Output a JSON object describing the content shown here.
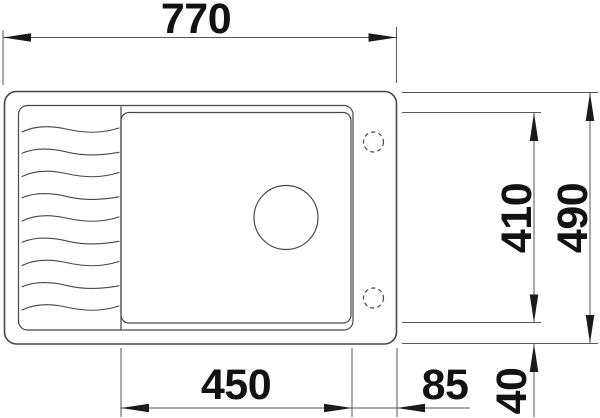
{
  "meta": {
    "drawing_type": "technical dimension drawing",
    "subject": "inset kitchen sink with drainboard, top view"
  },
  "colors": {
    "background": "#ffffff",
    "outline": "#474747",
    "dimension": "#565656",
    "arrow": "#1a1a1a",
    "text": "#121212"
  },
  "dimensions_mm": {
    "overall_width": "770",
    "overall_depth": "490",
    "bowl_width": "450",
    "bowl_depth": "410",
    "rim_right": "85",
    "rim_front": "40"
  }
}
